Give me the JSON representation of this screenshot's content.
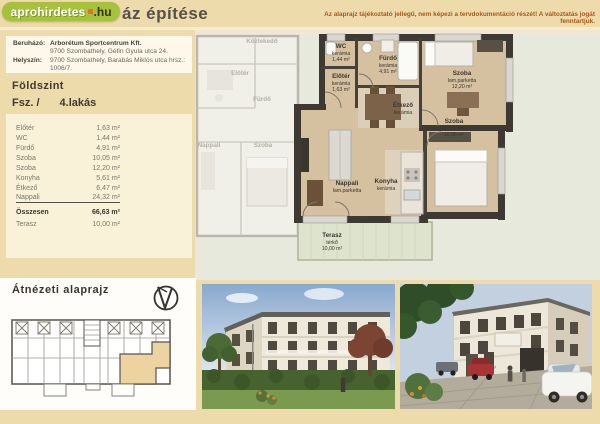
{
  "header": {
    "logo": {
      "main": "aprohirdetes",
      "suffix": ".hu"
    },
    "title_visible": "áz építése",
    "disclaimer": "Az alaprajz tájékoztató jellegű, nem képezi a tervdokumentáció részét! A változtatás jogát fenntartjuk."
  },
  "info": {
    "developer_label": "Beruházó:",
    "developer_name": "Arborétum Sportcentrum Kft.",
    "developer_address": "9700 Szombathely, Géfin Gyula utca 24.",
    "location_label": "Helyszín:",
    "location_value": "9700 Szombathely, Barabás Miklós utca hrsz.: 1006/7."
  },
  "unit": {
    "floor_name": "Földszint",
    "level_prefix": "Fsz. /",
    "flat_number": "4.lakás"
  },
  "area_table": {
    "rows": [
      {
        "label": "Előtér",
        "value": "1,63 m²"
      },
      {
        "label": "WC",
        "value": "1,44 m²"
      },
      {
        "label": "Fürdő",
        "value": "4,91 m²"
      },
      {
        "label": "Szoba",
        "value": "10,05 m²"
      },
      {
        "label": "Szoba",
        "value": "12,20 m²"
      },
      {
        "label": "Konyha",
        "value": "5,61 m²"
      },
      {
        "label": "Étkező",
        "value": "6,47 m²"
      },
      {
        "label": "Nappali",
        "value": "24,32 m²"
      }
    ],
    "total_label": "Összesen",
    "total_value": "66,63 m²",
    "terrace_label": "Terasz",
    "terrace_value": "10,00 m²"
  },
  "floorplan": {
    "wc": {
      "name": "WC",
      "material": "kerámia",
      "area": "1,44 m²"
    },
    "eloter": {
      "name": "Előtér",
      "material": "kerámia",
      "area": "1,63 m²"
    },
    "furdo": {
      "name": "Fürdő",
      "material": "kerámia",
      "area": "4,91 m²"
    },
    "szoba_felso": {
      "name": "Szoba",
      "material": "lam.parketta",
      "area": "12,20 m²"
    },
    "szoba_also": {
      "name": "Szoba",
      "material": "lam.parketta",
      "area": "10,05 m²"
    },
    "etkezo": {
      "name": "Étkező",
      "material": "kerámia"
    },
    "konyha": {
      "name": "Konyha",
      "material": "kerámia"
    },
    "nappali": {
      "name": "Nappali",
      "material": "lam.parketta"
    },
    "terasz": {
      "name": "Terasz",
      "material": "térkő",
      "area": "10,00 m²"
    },
    "adjacent": {
      "kozlekedo": "Közlekedő",
      "eloter": "Előtér",
      "furdo": "Fürdő",
      "szoba": "Szoba",
      "nappali": "Nappali"
    }
  },
  "overview": {
    "heading": "Átnézeti alaprajz"
  },
  "colors": {
    "page_bg": "#eedbab",
    "logo_green": "#a6c13c",
    "logo_orange": "#e0761c",
    "disclaimer_text": "#aa5618",
    "wall_dark": "#3e3a33",
    "floor_wood": "#d5c0a0",
    "terrace_green": "#dde3cc",
    "highlight_unit": "#edd3a0"
  }
}
